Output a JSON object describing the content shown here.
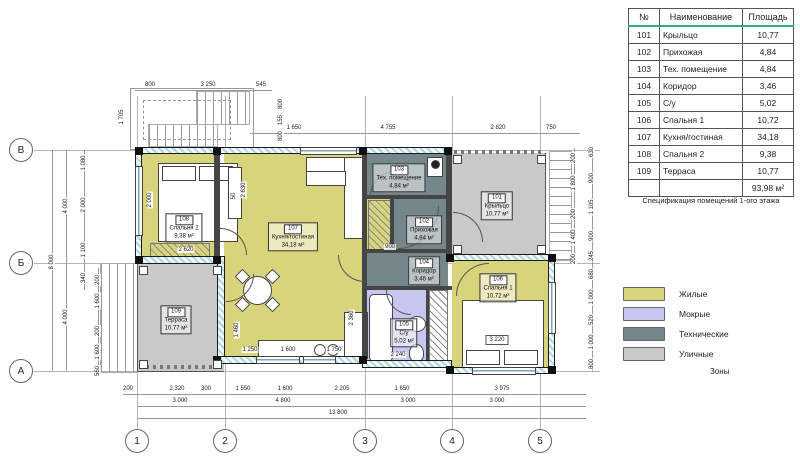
{
  "spec_table": {
    "headers": [
      "№",
      "Наименование",
      "Площадь"
    ],
    "rows": [
      {
        "num": "101",
        "name": "Крыльцо",
        "area": "10,77"
      },
      {
        "num": "102",
        "name": "Прихожая",
        "area": "4,84"
      },
      {
        "num": "103",
        "name": "Тех. помещение",
        "area": "4,84"
      },
      {
        "num": "104",
        "name": "Коридор",
        "area": "3,46"
      },
      {
        "num": "105",
        "name": "С/у",
        "area": "5,02"
      },
      {
        "num": "106",
        "name": "Спальня 1",
        "area": "10,72"
      },
      {
        "num": "107",
        "name": "Кухня/гостиная",
        "area": "34,18"
      },
      {
        "num": "108",
        "name": "Спальня 2",
        "area": "9,38"
      },
      {
        "num": "109",
        "name": "Терраса",
        "area": "10,77"
      }
    ],
    "total_row": {
      "num": "",
      "name": "",
      "area": "93,98 м²"
    },
    "caption": "Спецификация помещений 1-ого этажа"
  },
  "legend": {
    "items": [
      {
        "label": "Жилые",
        "color": "#d8d47c"
      },
      {
        "label": "Мокрые",
        "color": "#c7c6f0"
      },
      {
        "label": "Технические",
        "color": "#76878b"
      },
      {
        "label": "Уличные",
        "color": "#c9c9c9"
      }
    ],
    "caption": "Зоны"
  },
  "rooms": [
    {
      "num": "101",
      "name": "Крыльцо",
      "area": "10,77 м²",
      "zone": "Уличные"
    },
    {
      "num": "102",
      "name": "Прихожая",
      "area": "4,84 м²",
      "zone": "Технические"
    },
    {
      "num": "103",
      "name": "Тех. помещение",
      "area": "4,84 м²",
      "zone": "Технические"
    },
    {
      "num": "104",
      "name": "Коридор",
      "area": "3,46 м²",
      "zone": "Технические"
    },
    {
      "num": "105",
      "name": "С/у",
      "area": "5,02 м²",
      "zone": "Мокрые"
    },
    {
      "num": "106",
      "name": "Спальня 1",
      "area": "10,72 м²",
      "zone": "Жилые"
    },
    {
      "num": "107",
      "name": "Кухня/гостиная",
      "area": "34,18 м²",
      "zone": "Жилые"
    },
    {
      "num": "108",
      "name": "Спальня 2",
      "area": "9,38 м²",
      "zone": "Жилые"
    },
    {
      "num": "109",
      "name": "Терраса",
      "area": "10,77 м²",
      "zone": "Уличные"
    }
  ],
  "grid": {
    "rows": [
      "В",
      "Б",
      "А"
    ],
    "cols": [
      "1",
      "2",
      "3",
      "4",
      "5"
    ]
  },
  "dims": {
    "stair_top": [
      "800",
      "3 250",
      "545"
    ],
    "stair_left": "1 705",
    "stair_right": [
      "800",
      "155",
      "800"
    ],
    "top": [
      "1 650",
      "4 755",
      "2 820",
      "750"
    ],
    "bottom1": [
      "200",
      "2 320",
      "300",
      "1 550",
      "1 600",
      "2 205",
      "1 650",
      "3 975"
    ],
    "bottom2": [
      "3 000",
      "4 800",
      "3 000",
      "3 000"
    ],
    "bottom3": "13 800",
    "left1": [
      "1 080",
      "2 000",
      "1 100",
      "340"
    ],
    "left2": [
      "200",
      "1 600",
      "200",
      "1 600",
      "560"
    ],
    "left3": [
      "4 000",
      "4 000"
    ],
    "left4": "8 000",
    "right1": [
      "200",
      "1 800",
      "200",
      "1 400",
      "200"
    ],
    "right2": [
      "630",
      "900",
      "1 105",
      "900",
      "245",
      "680",
      "1 000",
      "520",
      "1 000",
      "800"
    ],
    "interior": [
      "2 000",
      "2 630",
      "2 620",
      "50",
      "1 460",
      "2 360",
      "1 250",
      "1 600",
      "1 750",
      "3 220",
      "2 240",
      "900"
    ]
  }
}
